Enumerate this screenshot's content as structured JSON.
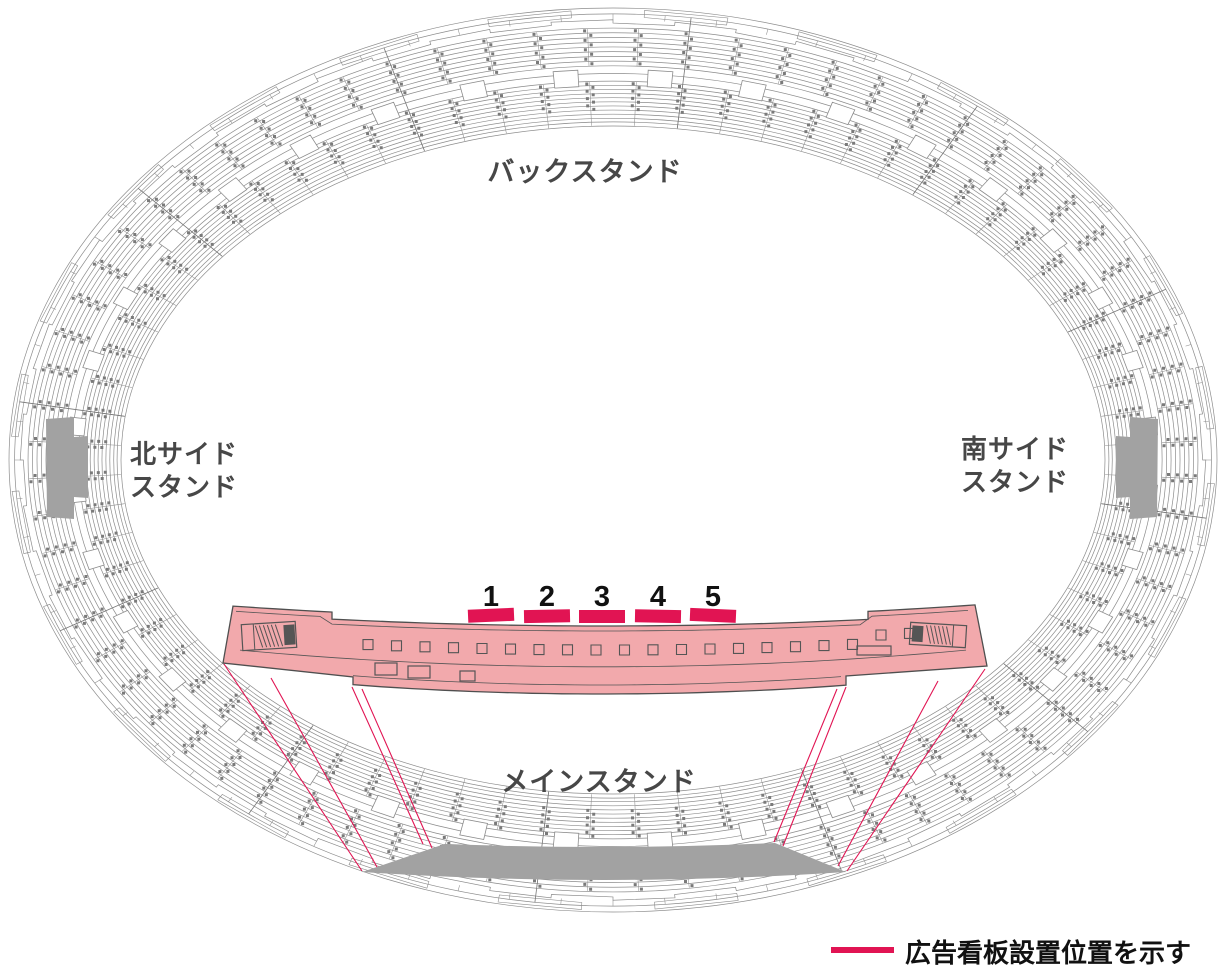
{
  "stands": {
    "back": "バックスタンド",
    "north_line1": "北サイド",
    "north_line2": "スタンド",
    "south_line1": "南サイド",
    "south_line2": "スタンド",
    "main": "メインスタンド"
  },
  "billboards": [
    "1",
    "2",
    "3",
    "4",
    "5"
  ],
  "legend": {
    "label": "広告看板設置位置を示す"
  },
  "colors": {
    "accent": "#e11453",
    "band_fill": "#f2a9ac",
    "band_stroke": "#4f4f4f",
    "band_detail": "#555555",
    "bowl_line": "#8c8c8c",
    "section_line": "#777777",
    "tick": "#7a7a7a",
    "gray_zone": "#a2a2a2",
    "label_text": "#474747",
    "number_text": "#111111",
    "background": "#ffffff"
  }
}
